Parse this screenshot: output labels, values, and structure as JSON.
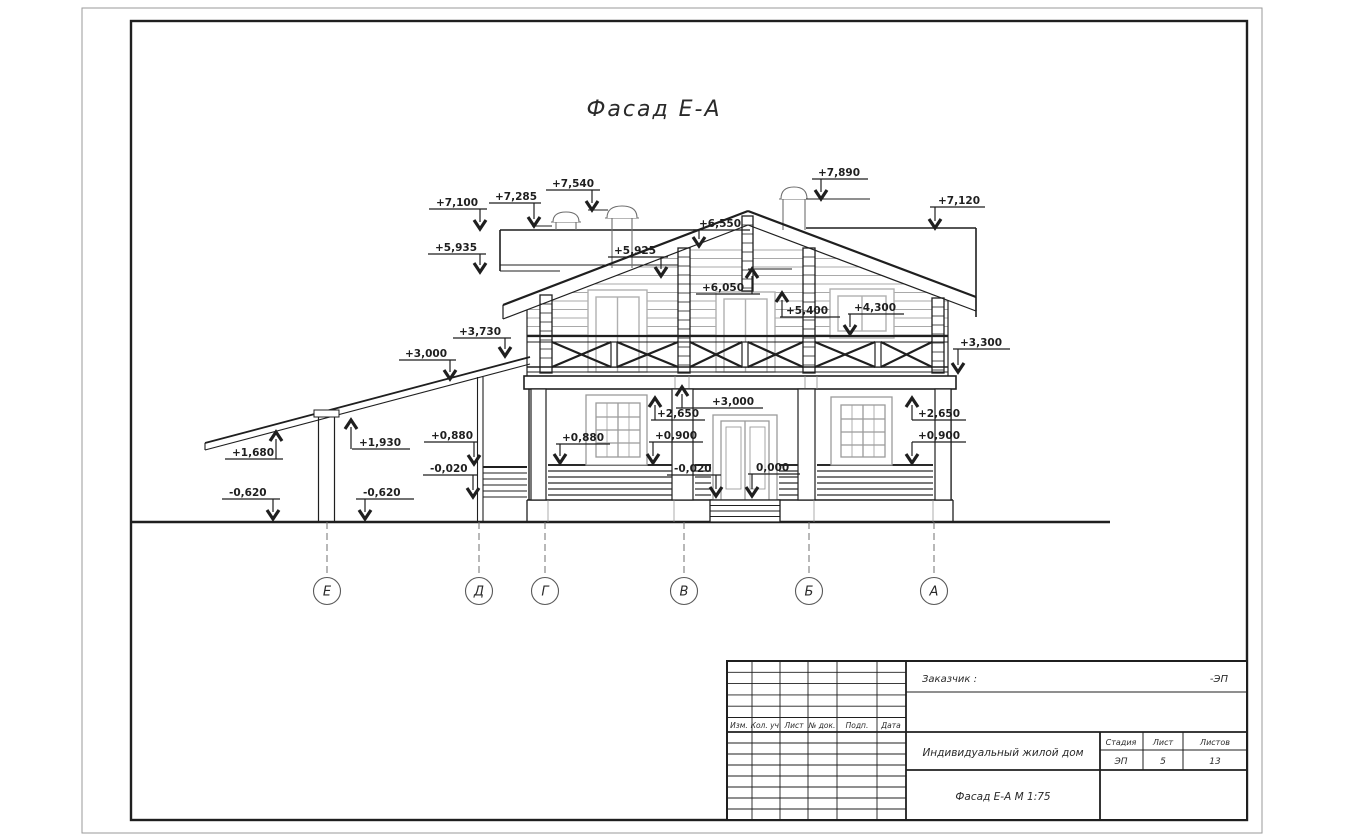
{
  "page": {
    "title": "Фасад Е-А"
  },
  "colors": {
    "line": "#1f1f1f",
    "thin": "#3a3a3a",
    "light": "#b0b0b0",
    "siding": "#a9a9a9",
    "dash": "#707070",
    "white": "#ffffff"
  },
  "marks": [
    {
      "label": "+7,100",
      "tx": 436,
      "ty": 206,
      "u": [
        429,
        487,
        209
      ],
      "lx": 480,
      "tip": 229,
      "dir": "dn"
    },
    {
      "label": "+7,285",
      "tx": 495,
      "ty": 200,
      "u": [
        489,
        541,
        203
      ],
      "lx": 534,
      "tip": 226,
      "dir": "dn",
      "ref": [
        532,
        552,
        226
      ]
    },
    {
      "label": "+7,540",
      "tx": 552,
      "ty": 187,
      "u": [
        546,
        600,
        190
      ],
      "lx": 592,
      "tip": 210,
      "dir": "dn",
      "ref": [
        588,
        608,
        210
      ]
    },
    {
      "label": "+7,890",
      "tx": 818,
      "ty": 176,
      "u": [
        812,
        868,
        179
      ],
      "lx": 821,
      "tip": 199,
      "dir": "dn",
      "ref": [
        806,
        870,
        199
      ]
    },
    {
      "label": "+7,120",
      "tx": 938,
      "ty": 204,
      "u": [
        930,
        985,
        207
      ],
      "lx": 935,
      "tip": 228,
      "dir": "dn"
    },
    {
      "label": "+5,935",
      "tx": 435,
      "ty": 251,
      "u": [
        428,
        486,
        254
      ],
      "lx": 480,
      "tip": 272,
      "dir": "dn"
    },
    {
      "label": "+5,925",
      "tx": 614,
      "ty": 254,
      "u": [
        608,
        668,
        257
      ],
      "lx": 661,
      "tip": 276,
      "dir": "dn"
    },
    {
      "label": "+6,550",
      "tx": 699,
      "ty": 227,
      "u": [
        693,
        750,
        230
      ],
      "lx": 699,
      "tip": 246,
      "dir": "dn"
    },
    {
      "label": "+6,050",
      "tx": 702,
      "ty": 291,
      "u": [
        696,
        760,
        294
      ],
      "lx": 752,
      "tip": 269,
      "dir": "up",
      "ref": [
        748,
        792,
        269
      ]
    },
    {
      "label": "+5,400",
      "tx": 786,
      "ty": 314,
      "u": [
        780,
        840,
        317
      ],
      "lx": 782,
      "tip": 293,
      "dir": "up"
    },
    {
      "label": "+4,300",
      "tx": 854,
      "ty": 311,
      "u": [
        848,
        904,
        314
      ],
      "lx": 850,
      "tip": 334,
      "dir": "dn"
    },
    {
      "label": "+3,730",
      "tx": 459,
      "ty": 335,
      "u": [
        453,
        511,
        338
      ],
      "lx": 505,
      "tip": 356,
      "dir": "dn"
    },
    {
      "label": "+3,000",
      "tx": 405,
      "ty": 357,
      "u": [
        399,
        456,
        360
      ],
      "lx": 450,
      "tip": 379,
      "dir": "dn"
    },
    {
      "label": "+3,300",
      "tx": 960,
      "ty": 346,
      "u": [
        953,
        1010,
        349
      ],
      "lx": 958,
      "tip": 372,
      "dir": "dn"
    },
    {
      "label": "+3,000",
      "tx": 712,
      "ty": 405,
      "u": [
        676,
        763,
        408
      ],
      "lx": 682,
      "tip": 387,
      "dir": "up"
    },
    {
      "label": "+2,650",
      "tx": 657,
      "ty": 417,
      "u": [
        651,
        705,
        420
      ],
      "lx": 655,
      "tip": 398,
      "dir": "up"
    },
    {
      "label": "+0,900",
      "tx": 655,
      "ty": 439,
      "u": [
        649,
        703,
        442
      ],
      "lx": 653,
      "tip": 463,
      "dir": "dn"
    },
    {
      "label": "+0,880",
      "tx": 562,
      "ty": 441,
      "u": [
        556,
        610,
        444
      ],
      "lx": 560,
      "tip": 463,
      "dir": "dn"
    },
    {
      "label": "+2,650",
      "tx": 918,
      "ty": 417,
      "u": [
        912,
        966,
        420
      ],
      "lx": 912,
      "tip": 398,
      "dir": "up"
    },
    {
      "label": "+0,900",
      "tx": 918,
      "ty": 439,
      "u": [
        912,
        966,
        442
      ],
      "lx": 912,
      "tip": 463,
      "dir": "dn"
    },
    {
      "label": "+0,880",
      "tx": 431,
      "ty": 439,
      "u": [
        424,
        478,
        442
      ],
      "lx": 474,
      "tip": 464,
      "dir": "dn"
    },
    {
      "label": "-0,020",
      "tx": 430,
      "ty": 472,
      "u": [
        423,
        477,
        475
      ],
      "lx": 473,
      "tip": 497,
      "dir": "dn"
    },
    {
      "label": "-0,020",
      "tx": 674,
      "ty": 472,
      "u": [
        667,
        721,
        475
      ],
      "lx": 716,
      "tip": 496,
      "dir": "dn"
    },
    {
      "label": "0,000",
      "tx": 756,
      "ty": 471,
      "u": [
        748,
        800,
        474
      ],
      "lx": 752,
      "tip": 496,
      "dir": "dn"
    },
    {
      "label": "+1,930",
      "tx": 359,
      "ty": 446,
      "u": [
        352,
        410,
        449
      ],
      "lx": 351,
      "tip": 420,
      "dir": "up"
    },
    {
      "label": "+1,680",
      "tx": 232,
      "ty": 456,
      "u": [
        225,
        283,
        459
      ],
      "lx": 276,
      "tip": 432,
      "dir": "up"
    },
    {
      "label": "-0,620",
      "tx": 229,
      "ty": 496,
      "u": [
        222,
        280,
        499
      ],
      "lx": 273,
      "tip": 519,
      "dir": "dn"
    },
    {
      "label": "-0,620",
      "tx": 363,
      "ty": 496,
      "u": [
        356,
        414,
        499
      ],
      "lx": 365,
      "tip": 519,
      "dir": "dn"
    }
  ],
  "axes": {
    "line_top": 522,
    "line_bottom": 577,
    "circle_y": 591,
    "radius": 13.5,
    "items": [
      {
        "label": "Е",
        "x": 327
      },
      {
        "label": "Д",
        "x": 479
      },
      {
        "label": "Г",
        "x": 545
      },
      {
        "label": "В",
        "x": 684
      },
      {
        "label": "Б",
        "x": 809
      },
      {
        "label": "А",
        "x": 934
      }
    ]
  },
  "title_block": {
    "customer_label": "Заказчик :",
    "code": "-ЭП",
    "object_name": "Индивидуальный жилой дом",
    "stage_label": "Стадия",
    "sheet_label": "Лист",
    "sheets_label": "Листов",
    "stage_value": "ЭП",
    "sheet_value": "5",
    "sheets_value": "13",
    "drawing_name": "Фасад Е-А  М 1:75",
    "rev_cols": [
      "Изм.",
      "Кол. уч.",
      "Лист",
      "№ док.",
      "Подп.",
      "Дата"
    ]
  }
}
